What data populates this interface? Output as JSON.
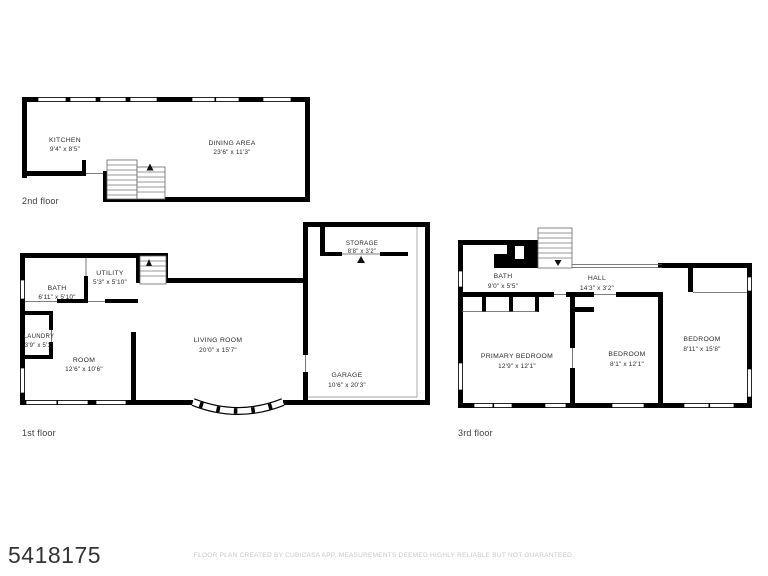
{
  "meta": {
    "listing_id": "5418175",
    "disclaimer": "FLOOR PLAN CREATED BY CUBICASA APP. MEASUREMENTS DEEMED HIGHLY RELIABLE BUT NOT GUARANTEED."
  },
  "colors": {
    "wall": "#000000",
    "room_text": "#2b2b2b",
    "disclaimer_text": "#c7c7c7"
  },
  "floors": {
    "second": {
      "label": "2nd floor",
      "rooms": {
        "kitchen": {
          "name": "KITCHEN",
          "dims": "9'4\" x 8'5\""
        },
        "dining_area": {
          "name": "DINING AREA",
          "dims": "23'6\" x 11'3\""
        }
      }
    },
    "first": {
      "label": "1st floor",
      "rooms": {
        "bath": {
          "name": "BATH",
          "dims": "6'11\" x 5'10\""
        },
        "utility": {
          "name": "UTILITY",
          "dims": "5'3\" x 5'10\""
        },
        "laundry": {
          "name": "LAUNDRY",
          "dims": "3'9\" x 5'1\""
        },
        "room": {
          "name": "ROOM",
          "dims": "12'6\" x 10'6\""
        },
        "living_room": {
          "name": "LIVING ROOM",
          "dims": "20'0\" x 15'7\""
        },
        "storage": {
          "name": "STORAGE",
          "dims": "8'8\" x 3'2\""
        },
        "garage": {
          "name": "GARAGE",
          "dims": "10'6\" x 20'3\""
        }
      }
    },
    "third": {
      "label": "3rd floor",
      "rooms": {
        "bath": {
          "name": "BATH",
          "dims": "9'0\" x 5'5\""
        },
        "hall": {
          "name": "HALL",
          "dims": "14'3\" x 3'2\""
        },
        "primary_bedroom": {
          "name": "PRIMARY BEDROOM",
          "dims": "12'9\" x 12'1\""
        },
        "bedroom_center": {
          "name": "BEDROOM",
          "dims": "8'1\" x 12'1\""
        },
        "bedroom_right": {
          "name": "BEDROOM",
          "dims": "8'11\" x 15'8\""
        }
      }
    }
  }
}
